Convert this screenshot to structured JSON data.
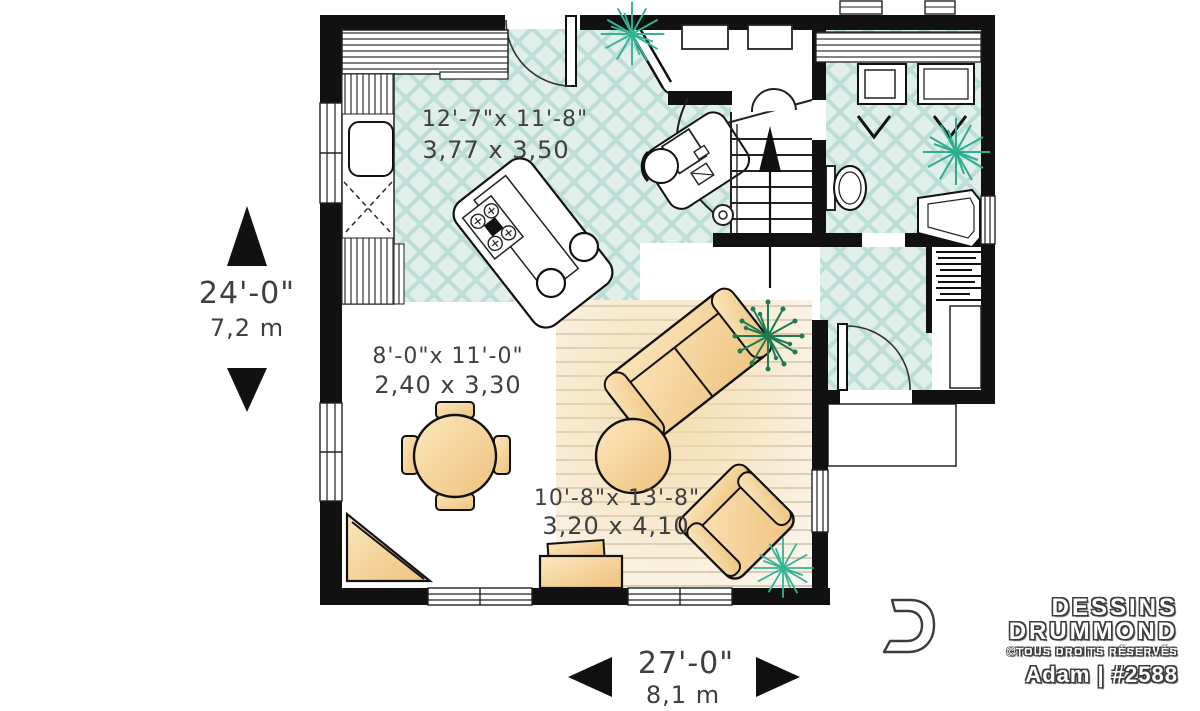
{
  "plan": {
    "rooms": [
      {
        "name": "kitchen",
        "imperial": "12'-7\"x 11'-8\"",
        "metric": "3,77 x 3,50"
      },
      {
        "name": "dining",
        "imperial": "8'-0\"x 11'-0\"",
        "metric": "2,40 x 3,30"
      },
      {
        "name": "living",
        "imperial": "10'-8\"x 13'-8\"",
        "metric": "3,20 x 4,10"
      }
    ],
    "overall": {
      "depth_imperial": "24'-0\"",
      "depth_metric": "7,2 m",
      "width_imperial": "27'-0\"",
      "width_metric": "8,1 m"
    }
  },
  "branding": {
    "studio_line1": "DESSINS",
    "studio_line2": "DRUMMOND",
    "rights": "©TOUS DROITS RÉSERVÉS",
    "model": "Adam | #2588"
  },
  "colors": {
    "wall": "#111111",
    "tile_floor": "#e1efeb",
    "tile_line": "#bcded6",
    "wood_floor": "#fbf6ee",
    "wood_line": "#d6cbbb",
    "furniture_tan": "#f6d79b",
    "furniture_tan_dark": "#eec27d",
    "plant_teal": "#35b493",
    "plant_green": "#1d7a52",
    "text": "#3f3f3f"
  },
  "fixtures": [
    "kitchen-island",
    "cooktop",
    "bar-stool",
    "kitchen-sink",
    "dishwasher",
    "kitchen-counter",
    "dining-table",
    "dining-chair",
    "sofa",
    "armchair",
    "ottoman",
    "tv-bench",
    "corner-unit",
    "stairs",
    "up-arrow",
    "desk",
    "desk-chair",
    "computer",
    "toilet",
    "washer",
    "dryer",
    "laundry-sink",
    "coat-hooks",
    "closet",
    "porch",
    "front-door",
    "patio-door",
    "plant",
    "window"
  ]
}
